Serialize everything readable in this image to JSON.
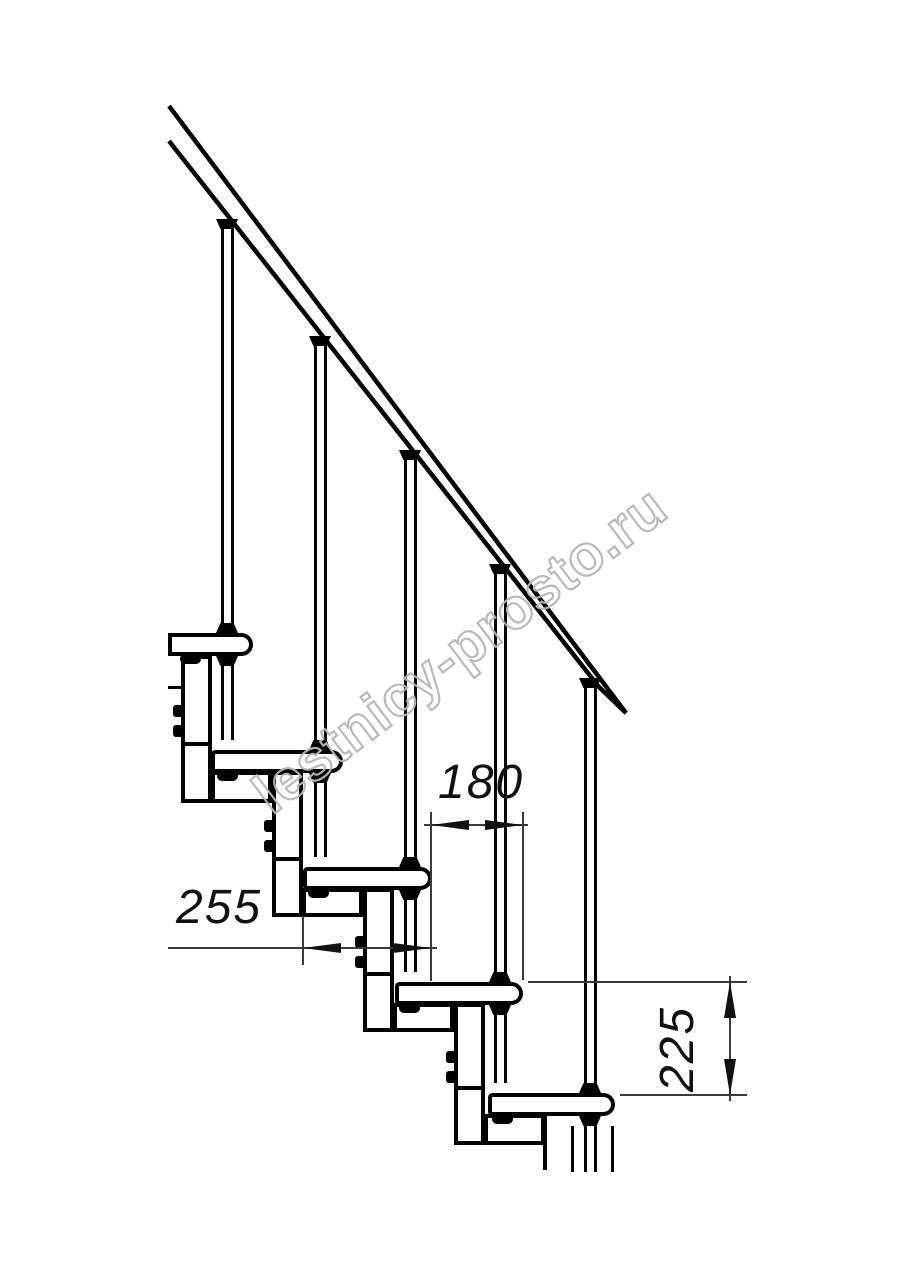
{
  "drawing": {
    "dimensions": {
      "step_run": "180",
      "tread_depth": "255",
      "step_height": "225"
    },
    "watermark": "lestnicy-prosto.ru"
  }
}
